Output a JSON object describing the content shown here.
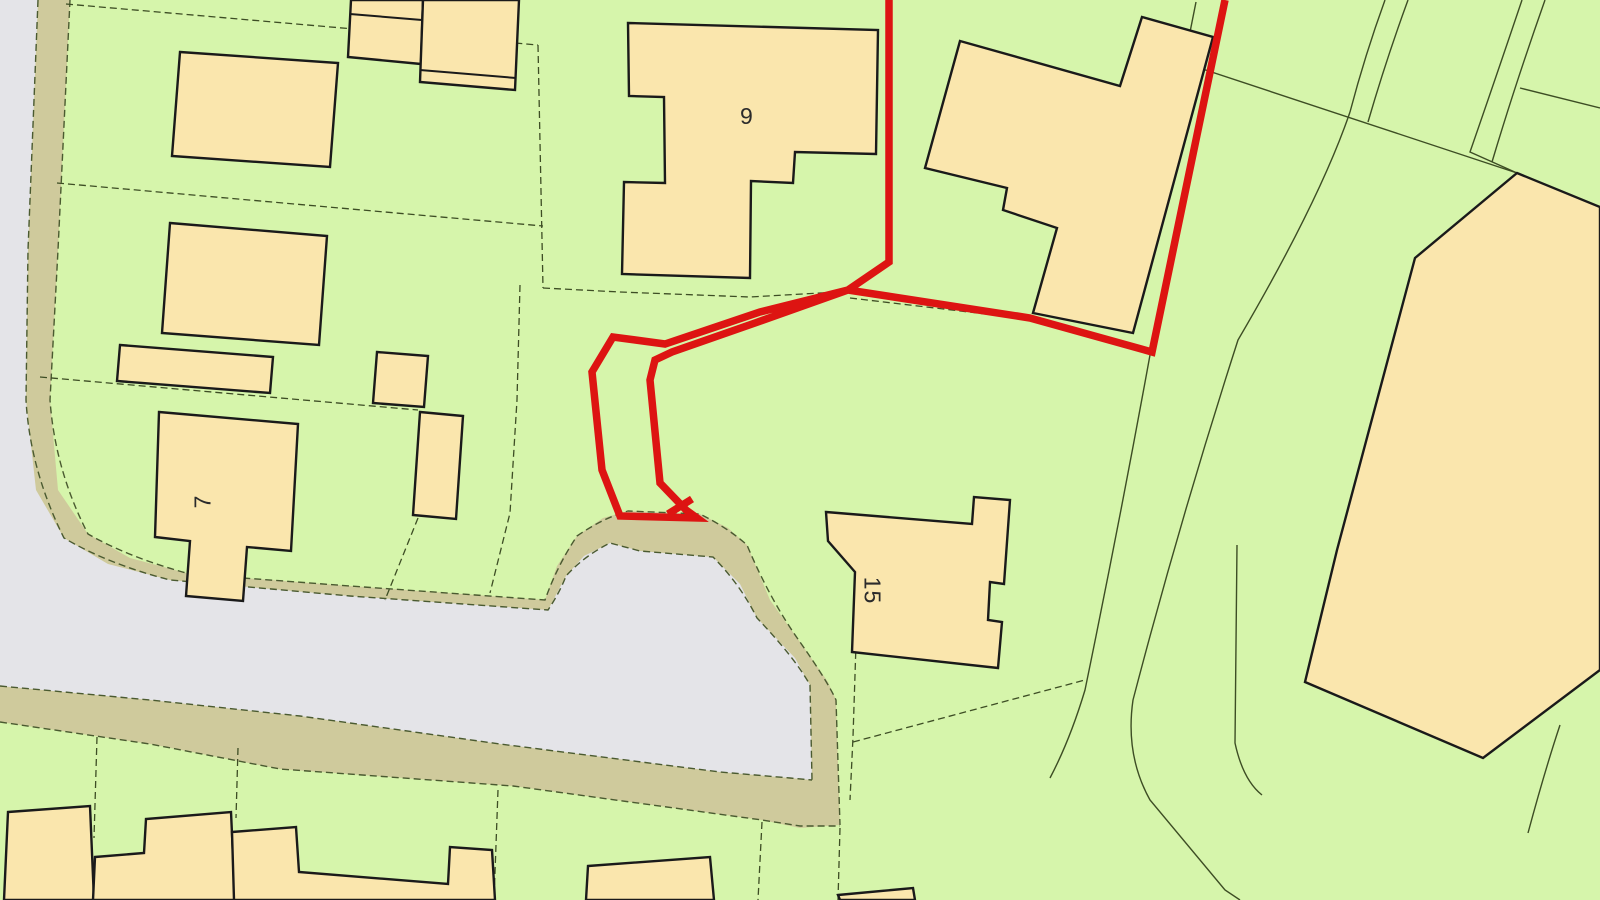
{
  "map": {
    "type": "cadastral-site-plan",
    "house_labels": {
      "plot9": "9",
      "plot7": "7",
      "plot15": "15"
    },
    "legend": {
      "site_boundary_color": "#dd1412",
      "parcel_fill_color": "#d6f5ab",
      "building_fill_color": "#fae6ad",
      "road_fill_color": "#e4e4e8",
      "verge_fill_color": "#cfca9c",
      "boundary_line_color": "#3d4d24",
      "building_outline_color": "#1a1a1a"
    }
  }
}
